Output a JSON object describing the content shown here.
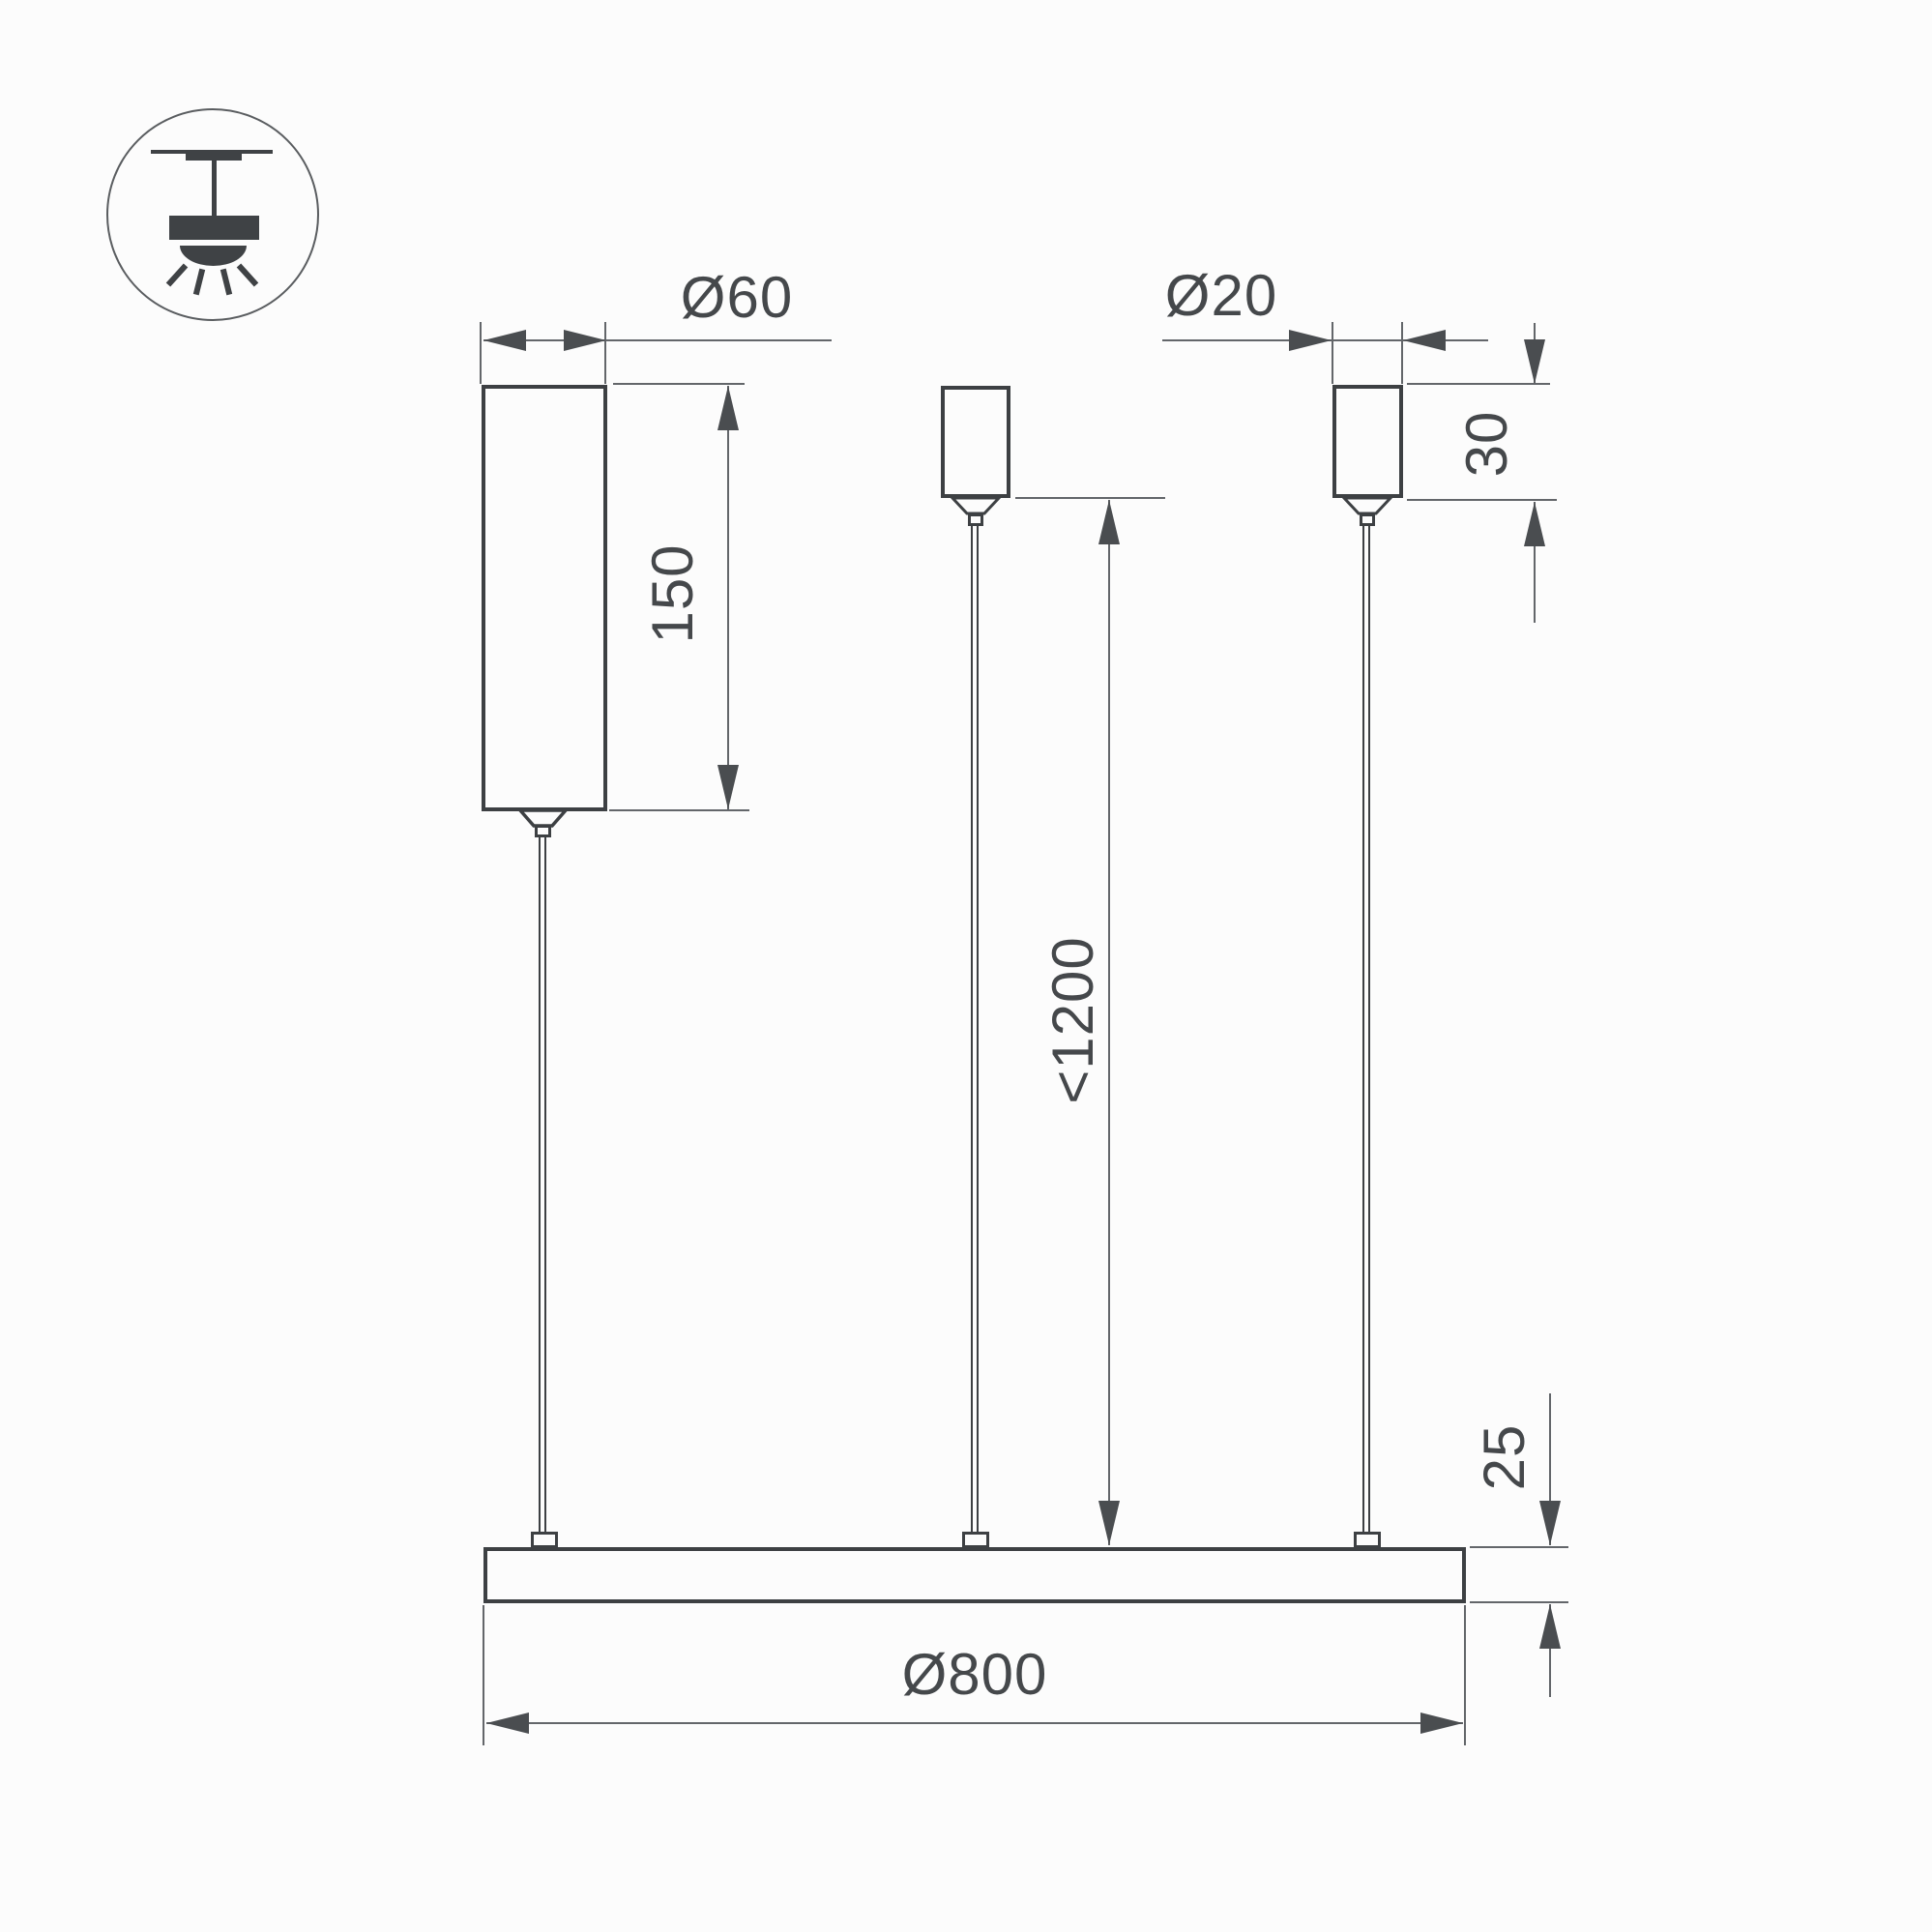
{
  "drawing": {
    "kind": "pendant-luminaire-dimension-drawing",
    "legend_icon": "pendant-ceiling-lamp-symbol"
  },
  "dimensions": {
    "driver": {
      "diameter": "Ø60",
      "length": "150"
    },
    "canopy": {
      "diameter": "Ø20",
      "height": "30"
    },
    "suspension": {
      "max_length": "<1200"
    },
    "panel": {
      "thickness": "25",
      "diameter": "Ø800"
    }
  },
  "colors": {
    "background": "#fcfcfc",
    "product_outline": "#3d4043",
    "dimension_line": "#63666a",
    "arrow": "#4a4d50",
    "label_text": "#45484b"
  }
}
